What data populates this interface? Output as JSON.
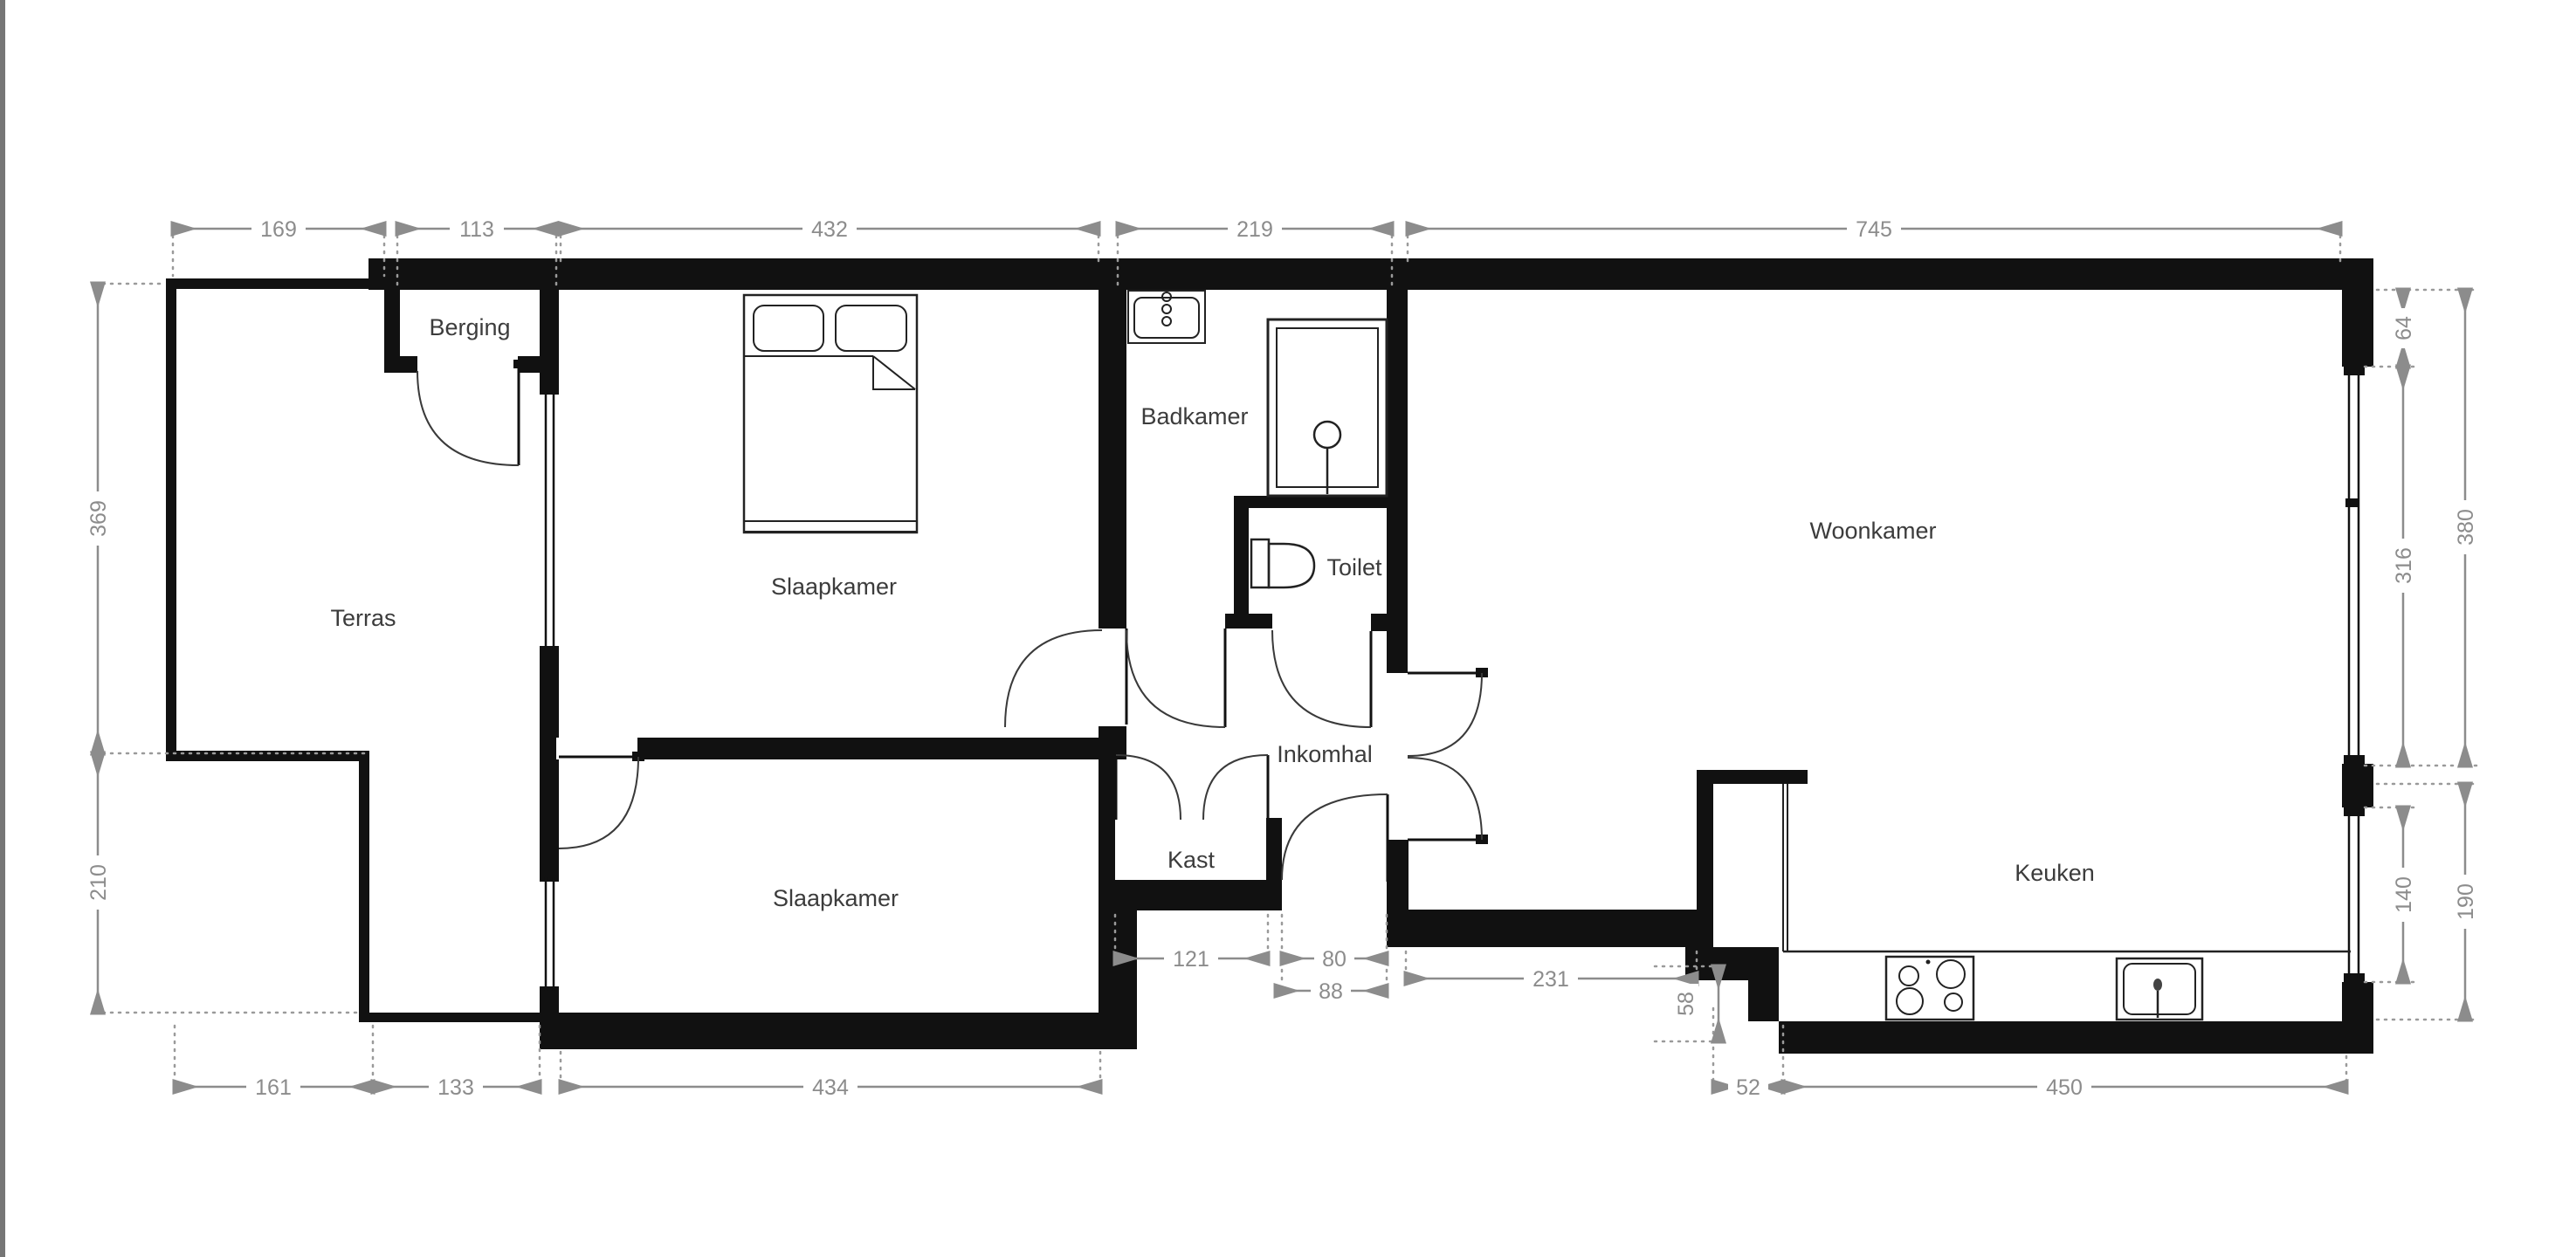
{
  "plan_type": "floor-plan",
  "colors": {
    "wall": "#111111",
    "dimension_annotation": "#8c8c8c",
    "room_label": "#3c3c3c",
    "background": "#ffffff",
    "left_edge_strip": "#767676"
  },
  "rooms": {
    "terras": "Terras",
    "berging": "Berging",
    "slaapkamer_top": "Slaapkamer",
    "badkamer": "Badkamer",
    "toilet": "Toilet",
    "inkomhal": "Inkomhal",
    "kast": "Kast",
    "slaapkamer_bottom": "Slaapkamer",
    "woonkamer": "Woonkamer",
    "keuken": "Keuken"
  },
  "dims": {
    "t169": "169",
    "t113": "113",
    "t432": "432",
    "t219": "219",
    "t745": "745",
    "l369": "369",
    "l210": "210",
    "ri64": "64",
    "ri316": "316",
    "ri140": "140",
    "ro380": "380",
    "ro190": "190",
    "b161": "161",
    "b133": "133",
    "b434": "434",
    "b52": "52",
    "b450": "450",
    "m121": "121",
    "m80": "80",
    "m88": "88",
    "m231": "231",
    "m58": "58"
  }
}
